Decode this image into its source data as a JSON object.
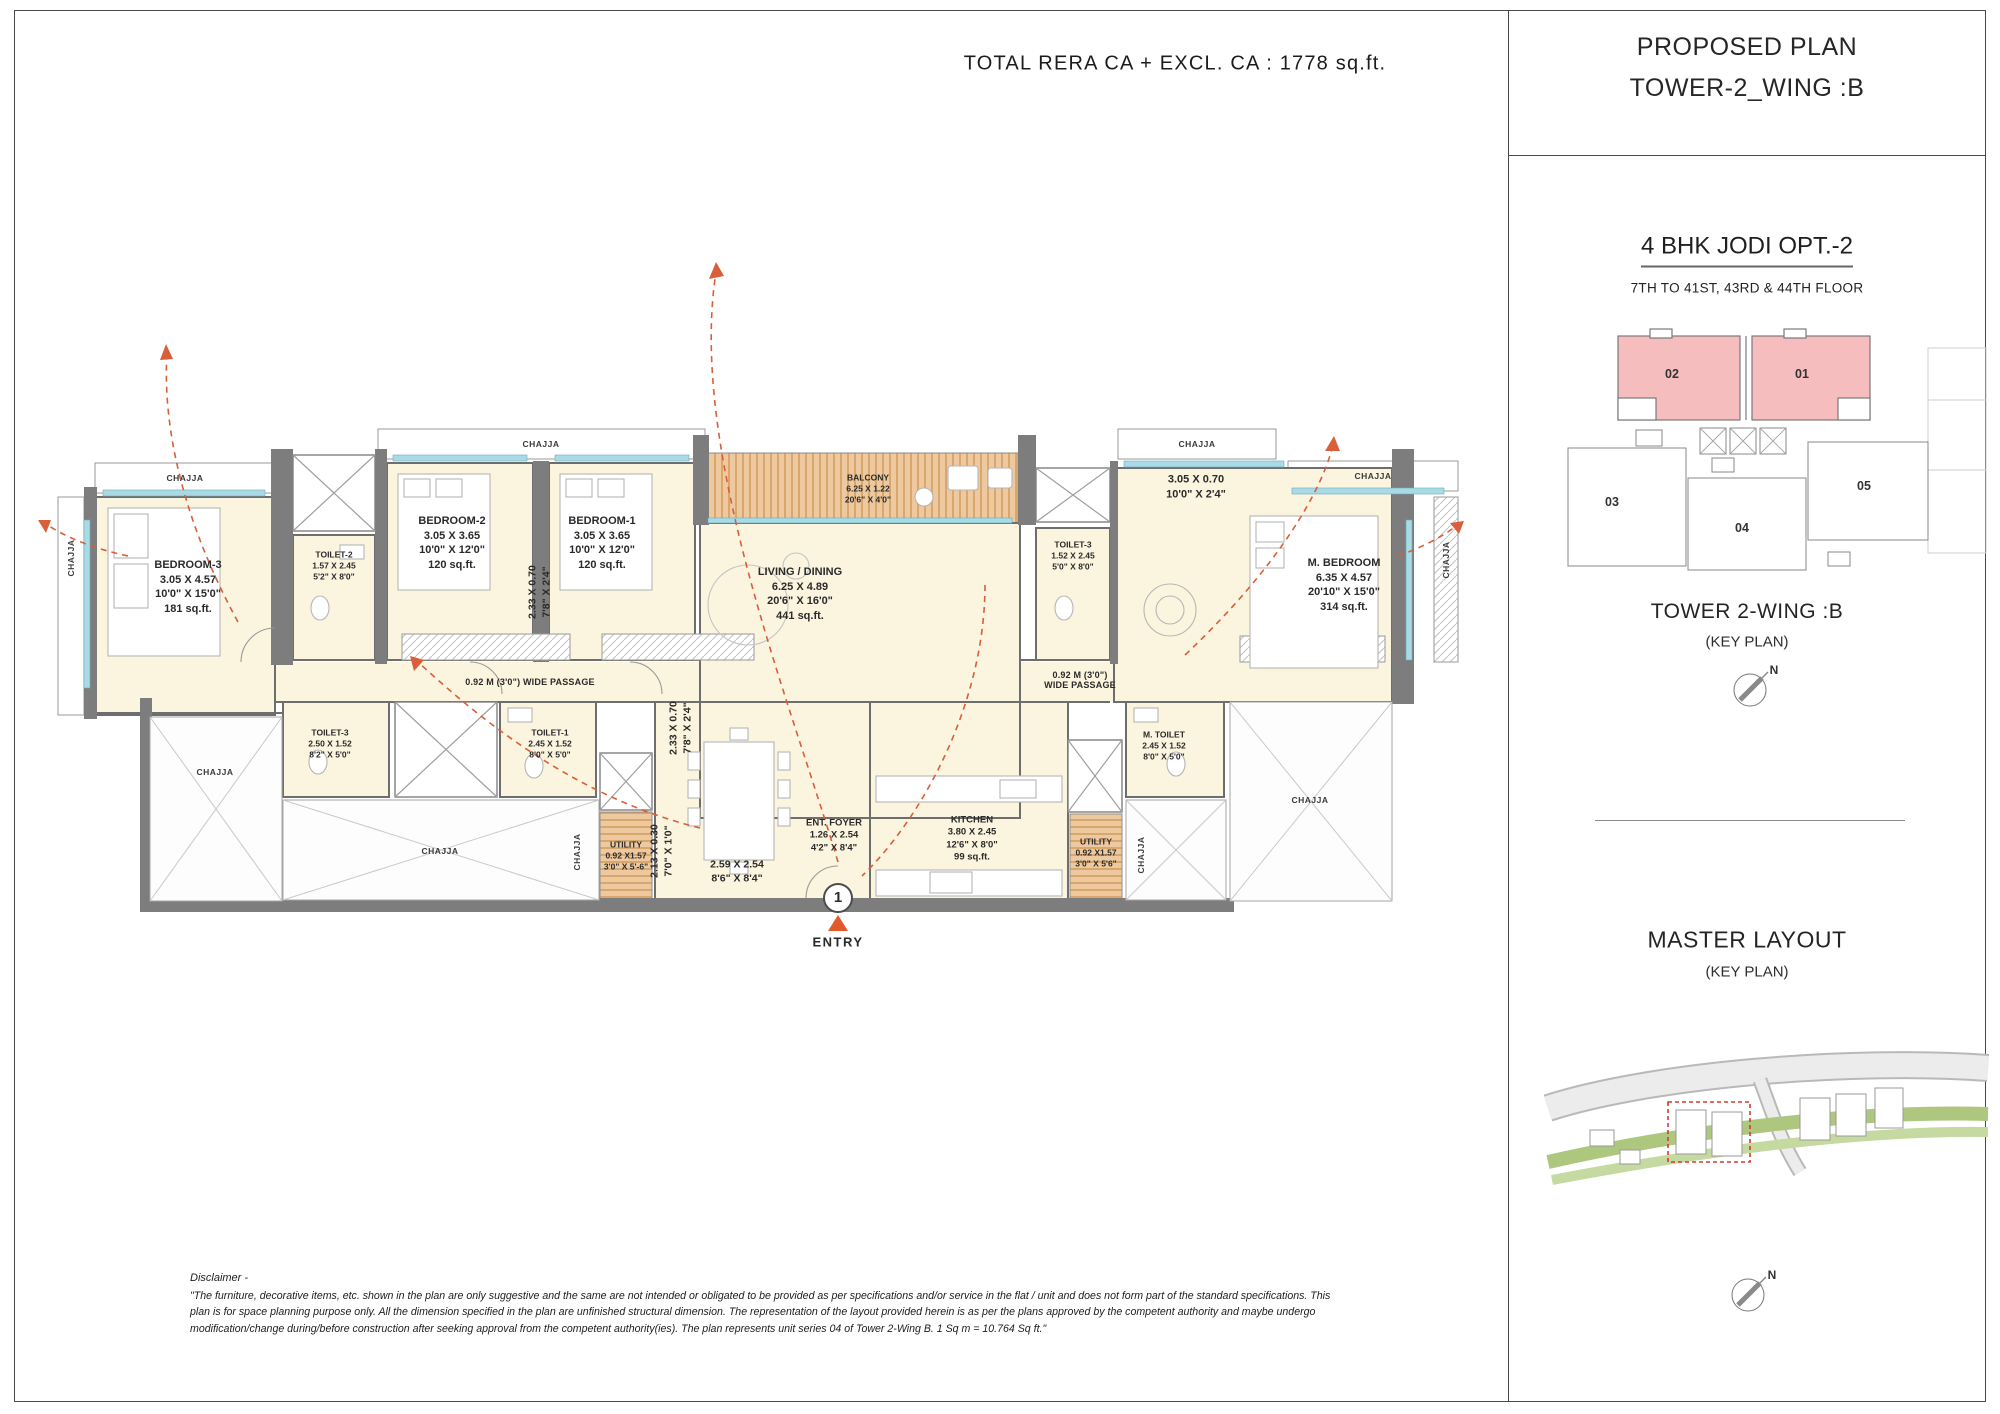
{
  "page": {
    "total_area_label": "TOTAL RERA CA + EXCL. CA : 1778 sq.ft."
  },
  "side_panel": {
    "title_line1": "PROPOSED PLAN",
    "title_line2": "TOWER-2_WING :B",
    "unit_type": "4 BHK JODI  OPT.-2",
    "floors": "7TH TO 41ST, 43RD & 44TH FLOOR",
    "key_units": [
      "02",
      "01",
      "03",
      "04",
      "05"
    ],
    "tower_key_title": "TOWER 2-WING :B",
    "tower_key_sub": "(KEY PLAN)",
    "master_title": "MASTER LAYOUT",
    "master_sub": "(KEY PLAN)",
    "north_label": "N",
    "highlight_color": "#f5bdbd"
  },
  "plan": {
    "chajja": "CHAJJA",
    "entry_number": "1",
    "entry_label": "ENTRY",
    "passage_left": "0.92 M (3'0\") WIDE PASSAGE",
    "passage_right_1": "0.92 M (3'0\")",
    "passage_right_2": "WIDE PASSAGE",
    "rooms": {
      "bedroom3": {
        "name": "BEDROOM-3",
        "m": "3.05 X 4.57",
        "ft": "10'0\" X 15'0\"",
        "area": "181 sq.ft."
      },
      "toilet2": {
        "name": "TOILET-2",
        "m": "1.57 X 2.45",
        "ft": "5'2\" X 8'0\""
      },
      "bedroom2": {
        "name": "BEDROOM-2",
        "m": "3.05 X 3.65",
        "ft": "10'0\" X 12'0\"",
        "area": "120 sq.ft."
      },
      "bedroom1": {
        "name": "BEDROOM-1",
        "m": "3.05 X 3.65",
        "ft": "10'0\" X 12'0\"",
        "area": "120 sq.ft."
      },
      "balcony": {
        "name": "BALCONY",
        "m": "6.25 X 1.22",
        "ft": "20'6\" X 4'0\""
      },
      "living": {
        "name": "LIVING / DINING",
        "m": "6.25 X 4.89",
        "ft": "20'6\" X 16'0\"",
        "area": "441 sq.ft."
      },
      "toilet3_upper": {
        "name": "TOILET-3",
        "m": "1.52 X 2.45",
        "ft": "5'0\" X 8'0\""
      },
      "sitout": {
        "m": "3.05 X 0.70",
        "ft": "10'0\" X 2'4\""
      },
      "m_bedroom": {
        "name": "M. BEDROOM",
        "m": "6.35 X 4.57",
        "ft": "20'10\" X 15'0\"",
        "area": "314 sq.ft."
      },
      "toilet3_lower": {
        "name": "TOILET-3",
        "m": "2.50 X 1.52",
        "ft": "8'2\" X 5'0\""
      },
      "toilet1": {
        "name": "TOILET-1",
        "m": "2.45 X 1.52",
        "ft": "8'0\" X 5'0\""
      },
      "utility_left": {
        "name": "UTILITY",
        "m": "0.92 X1.57",
        "ft": "3'0\" X 5'-6\""
      },
      "ent_foyer": {
        "name": "ENT. FOYER",
        "m": "1.26 X 2.54",
        "ft": "4'2\" X 8'4\""
      },
      "kitchen": {
        "name": "KITCHEN",
        "m": "3.80 X 2.45",
        "ft": "12'6\" X 8'0\"",
        "area": "99 sq.ft."
      },
      "utility_right": {
        "name": "UTILITY",
        "m": "0.92 X1.57",
        "ft": "3'0\" X 5'6\""
      },
      "m_toilet": {
        "name": "M. TOILET",
        "m": "2.45 X 1.52",
        "ft": "8'0\" X 5'0\""
      },
      "foyer_dim": {
        "m": "2.59 X 2.54",
        "ft": "8'6\" X 8'4\""
      },
      "niche_dim1": {
        "m": "2.33 X 0.70",
        "ft": "7'8\" X 2'4\""
      },
      "niche_dim2": {
        "m": "2.13 X 0.30",
        "ft": "7'0\" X 1'0\""
      }
    }
  },
  "disclaimer": {
    "title": "Disclaimer -",
    "body": "\"The furniture, decorative items, etc. shown in the plan are only suggestive and the same are not intended or obligated to be provided as per specifications and/or service in the flat / unit and does not form part of the standard specifications. This plan is for space planning purpose only. All the dimension specified in the plan are unfinished structural dimension. The representation of the layout provided herein is as per the plans approved by the competent authority and maybe undergo modification/change during/before construction after seeking approval from the competent authority(ies). The plan represents unit series 04 of Tower 2-Wing B. 1 Sq m = 10.764 Sq ft.\""
  }
}
